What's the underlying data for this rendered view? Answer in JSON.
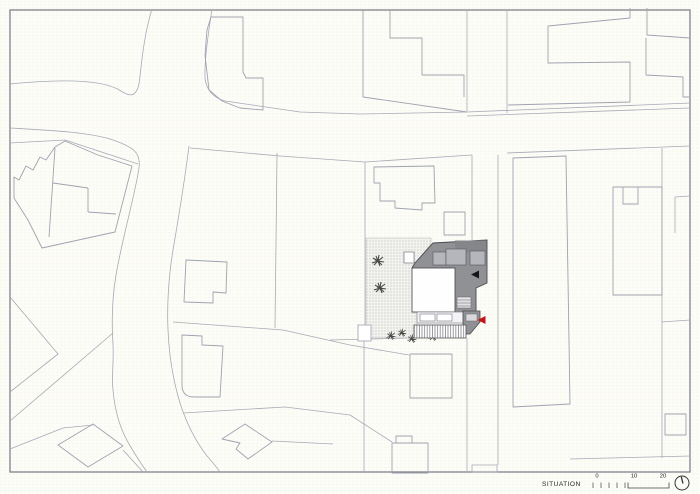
{
  "drawing": {
    "type": "architectural-site-plan",
    "main_building": "new building with inner courtyard, roof terraces, stairs and striped canopy",
    "site_features": [
      "stippled garden ground",
      "2 trees",
      "hedge row of 5 bushes"
    ],
    "markers": {
      "black_arrow": "entrance-arrow-left",
      "red_arrow": "access-arrow-left"
    }
  },
  "footer": {
    "title": "SITUATION",
    "scale_bar": {
      "labels": [
        "0",
        "10",
        "20"
      ]
    },
    "north_icon": "north-arrow"
  },
  "colors": {
    "building_gray": "#909195",
    "building_gray_dark": "#85868a",
    "roof_panel": "#b5b6bb",
    "arrow_black": "#161616",
    "arrow_red": "#c41414",
    "line": "#a6aab6",
    "frame": "#80828e"
  }
}
